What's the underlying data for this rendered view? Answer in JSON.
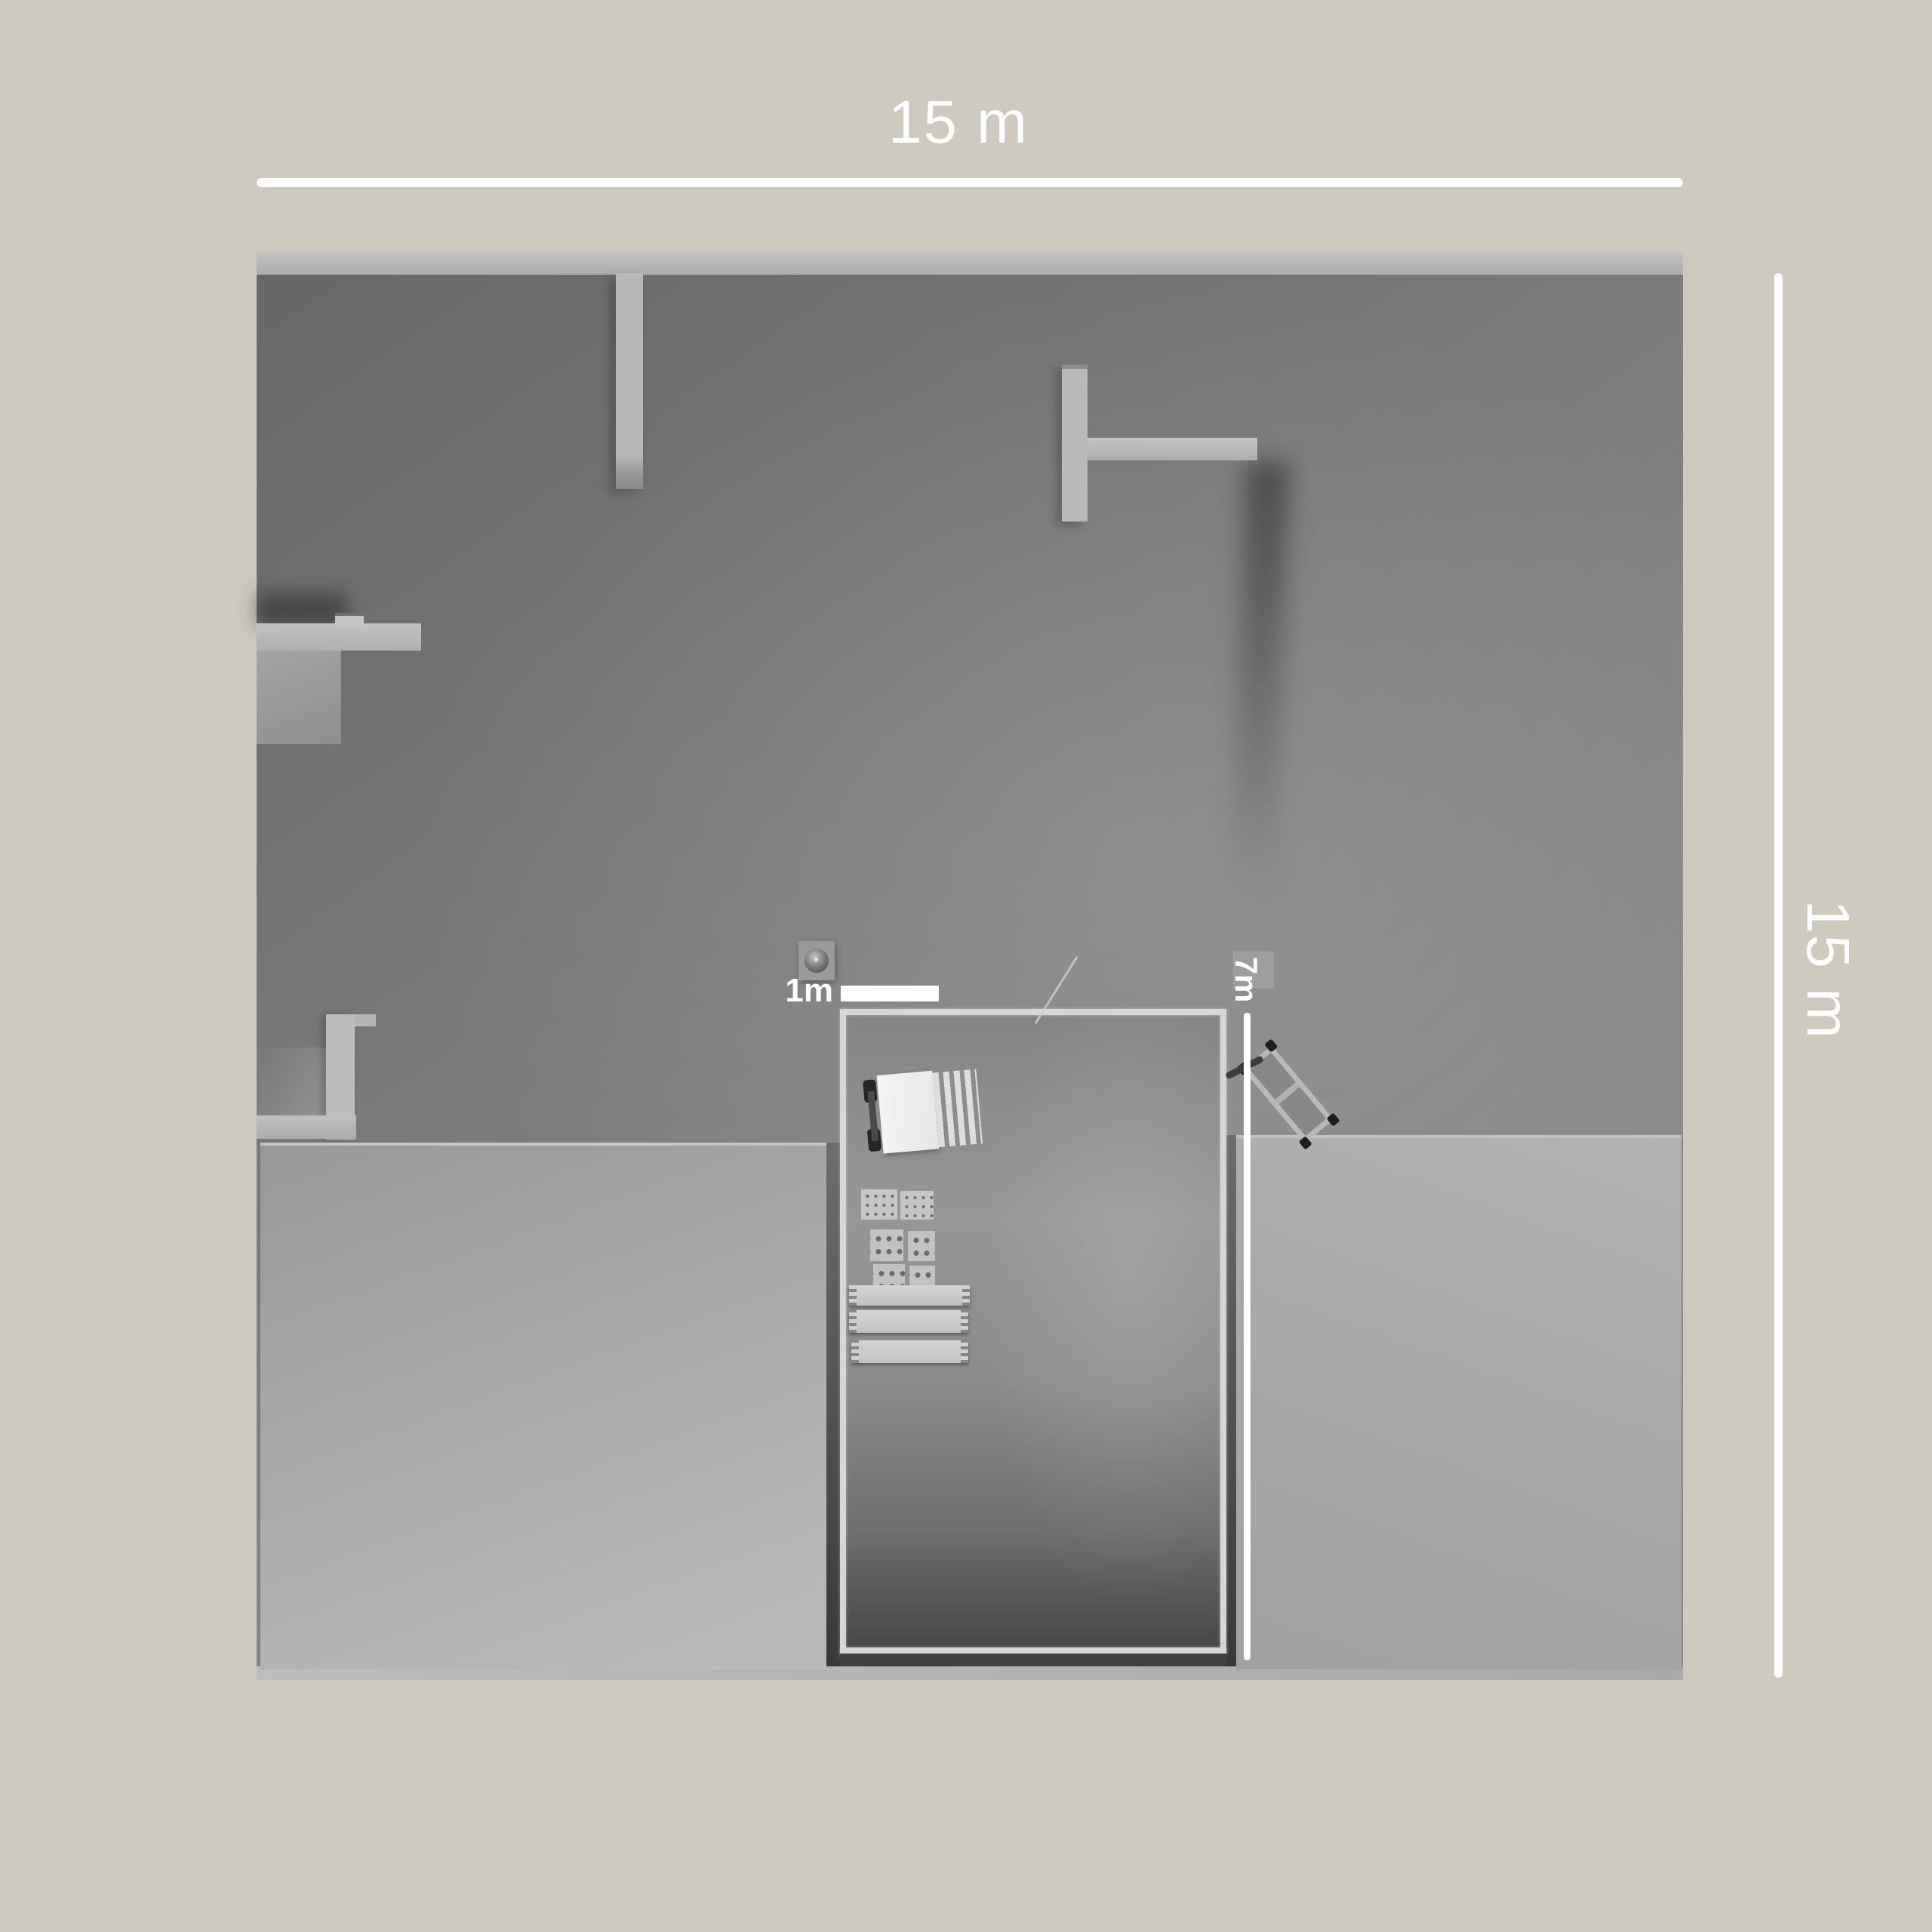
{
  "annotations": {
    "top_width_label": "15 m",
    "right_height_label": "15 m",
    "scale_label": "1m",
    "vertical_measure_label": "7m"
  },
  "colors": {
    "background_beige": "#cec9be",
    "dimension_white": "#ffffff",
    "floor_gray": "#7d7d7d",
    "wall_light_gray": "#b8b8b8",
    "slab_gray": "#aaaaaa",
    "enclosure_border": "#d6d6d6"
  },
  "objects": [
    "forklift",
    "stud-crate-stack-small",
    "stud-crate-stack-large",
    "plank-stack",
    "dome-sensor",
    "hand-trolley",
    "leaning-stick"
  ]
}
